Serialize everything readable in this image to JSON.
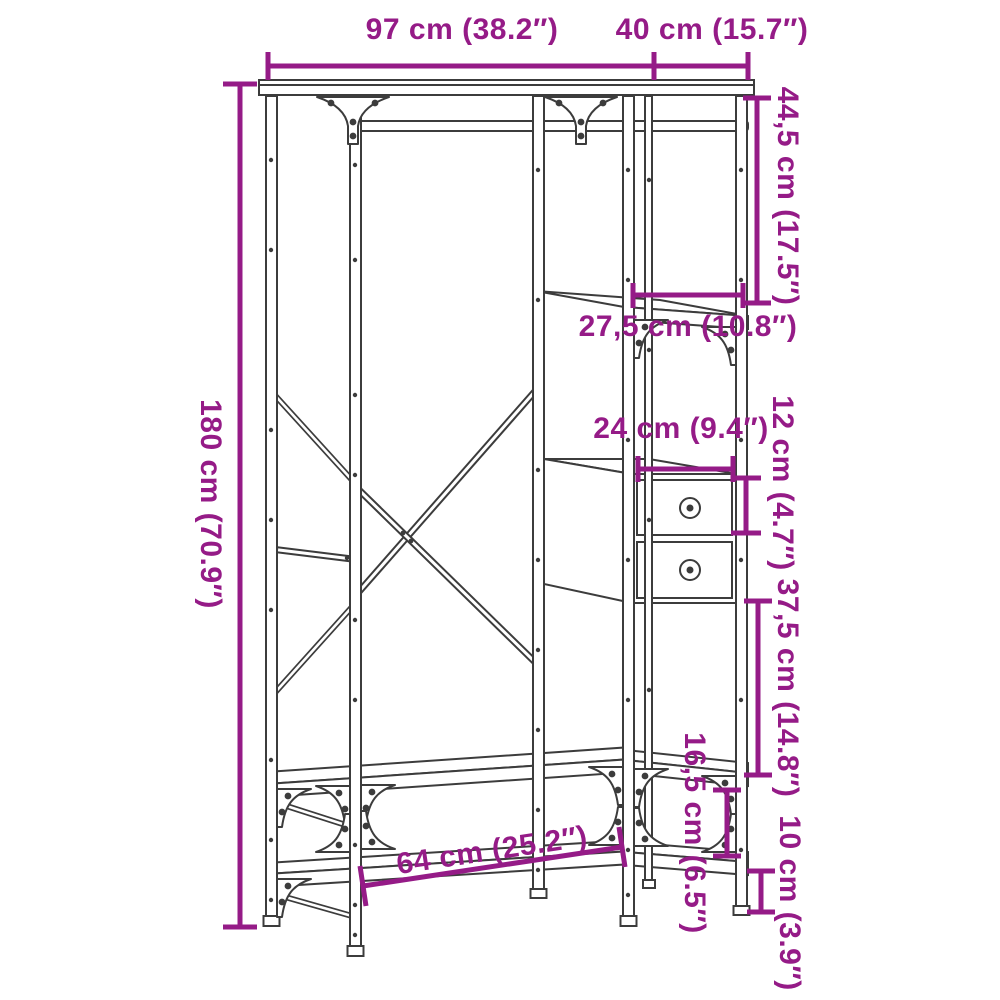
{
  "colors": {
    "dimension_annotation": "#951b87",
    "line_art": "#3c3c3c",
    "background": "#ffffff"
  },
  "diagram": {
    "type": "furniture-dimension-drawing",
    "subject": "open wardrobe clothes rack with shelves and two drawers",
    "dimensions": {
      "width_top": "97 cm (38.2″)",
      "depth_top": "40 cm (15.7″)",
      "height_left": "180 cm (70.9″)",
      "top_shelf_clearance": "44,5 cm (17.5″)",
      "shelf_width_right": "27,5 cm (10.8″)",
      "drawer_width": "24 cm (9.4″)",
      "drawer_height": "12 cm (4.7″)",
      "middle_clearance": "37,5 cm (14.8″)",
      "lower_shelf_clearance": "16,5 cm (6.5″)",
      "ground_clearance": "10 cm (3.9″)",
      "bench_width": "64 cm (25.2″)"
    }
  }
}
